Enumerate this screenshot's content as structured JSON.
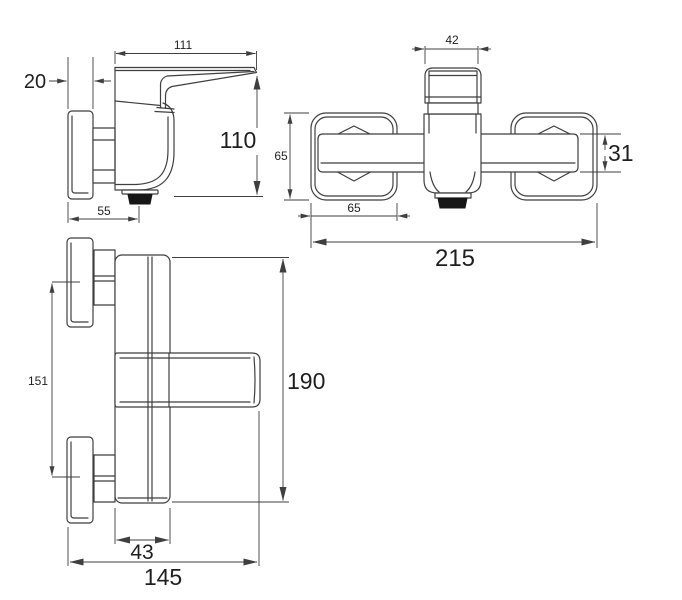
{
  "style": {
    "line": "#3f3f3f",
    "text": "#1f1f1f",
    "bg": "#ffffff",
    "dark": "#161616"
  },
  "views": {
    "side": {
      "name": "side-view",
      "dims": {
        "lever_length": "111",
        "wall_plate_thickness": "20",
        "total_height": "110",
        "wall_to_spout": "55"
      }
    },
    "front": {
      "name": "front-view",
      "dims": {
        "handle_width": "42",
        "escutcheon_height": "65",
        "spout_height": "31",
        "escutcheon_width": "65",
        "total_width": "215"
      }
    },
    "plan": {
      "name": "top-view",
      "dims": {
        "hole_center_distance": "151",
        "total_length": "190",
        "body_width": "43",
        "total_depth": "145"
      }
    }
  }
}
